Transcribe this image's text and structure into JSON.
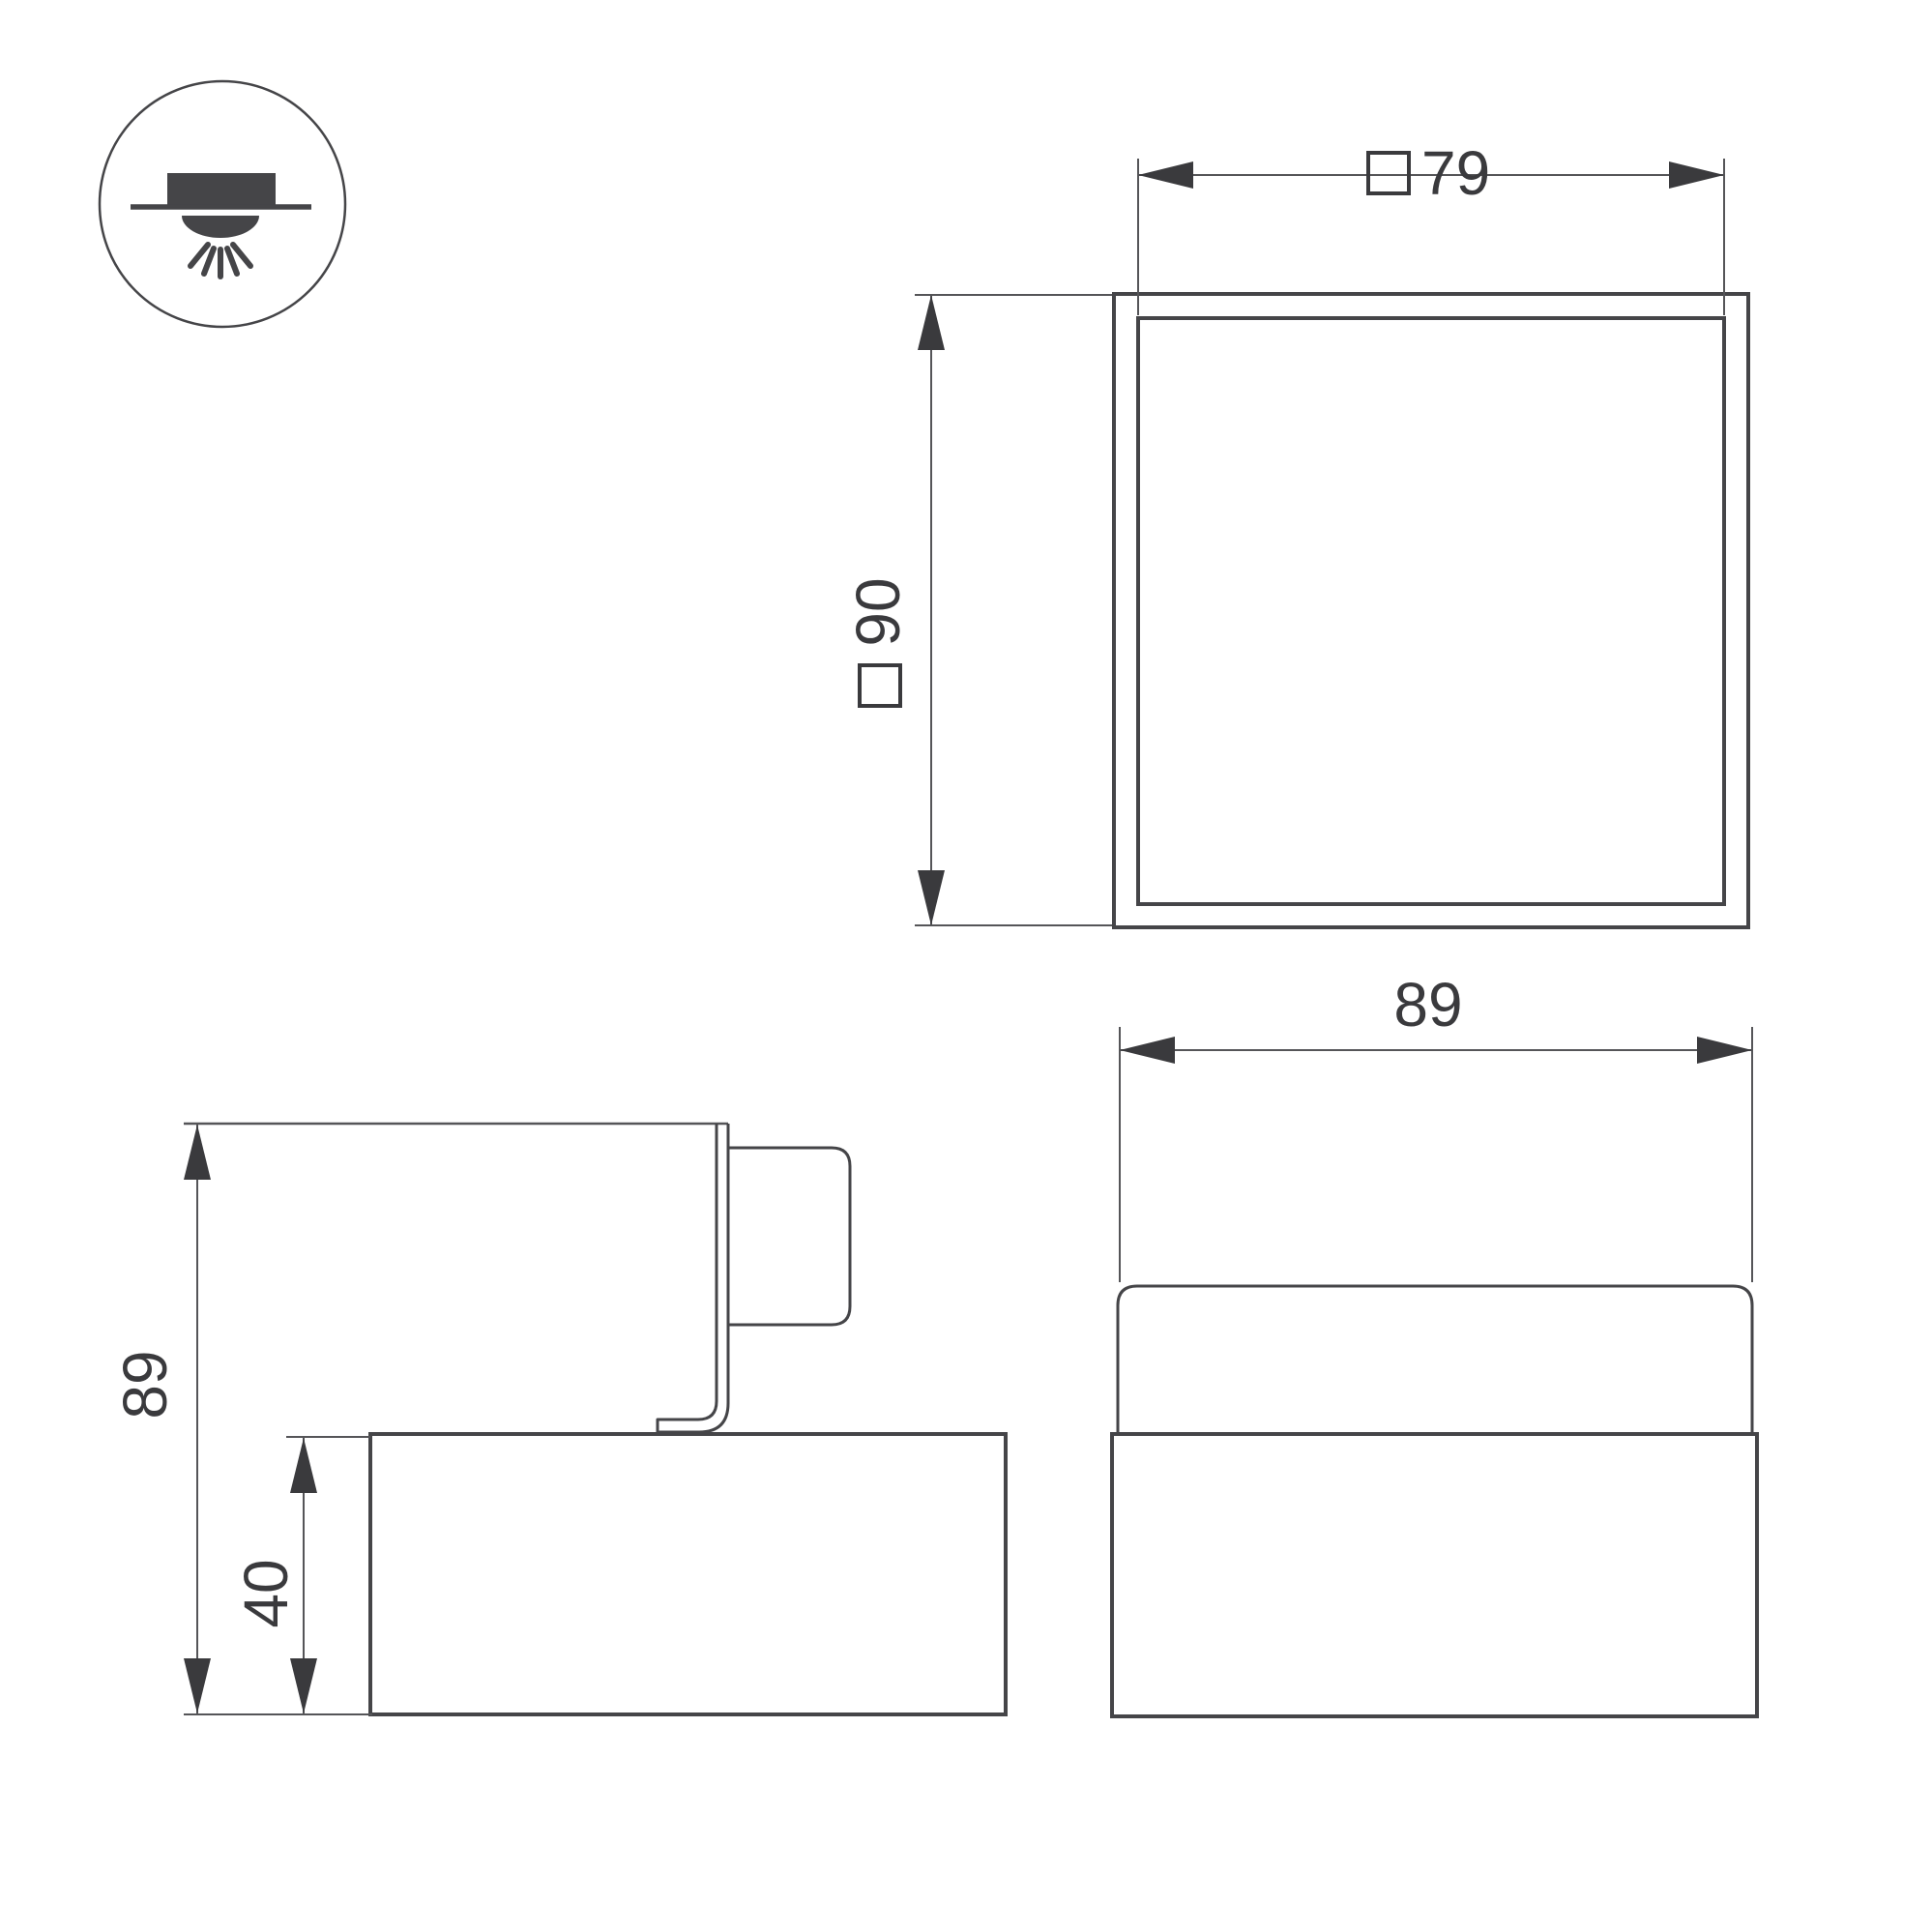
{
  "icon": {
    "name": "surface-mounted-downlight-icon",
    "description": "circled symbol of a surface/recessed ceiling downlight shining downward"
  },
  "top_view": {
    "width_dim": {
      "symbol": "□",
      "value": "79"
    },
    "height_dim": {
      "symbol": "□",
      "value": "90"
    }
  },
  "side_view": {
    "overall_height_dim": {
      "value": "89"
    },
    "base_height_dim": {
      "value": "40"
    }
  },
  "front_view": {
    "width_dim": {
      "value": "89"
    }
  },
  "colors": {
    "object_line": "#454548",
    "dim_line": "#555558",
    "text": "#3a3a3d",
    "background": "#ffffff"
  }
}
